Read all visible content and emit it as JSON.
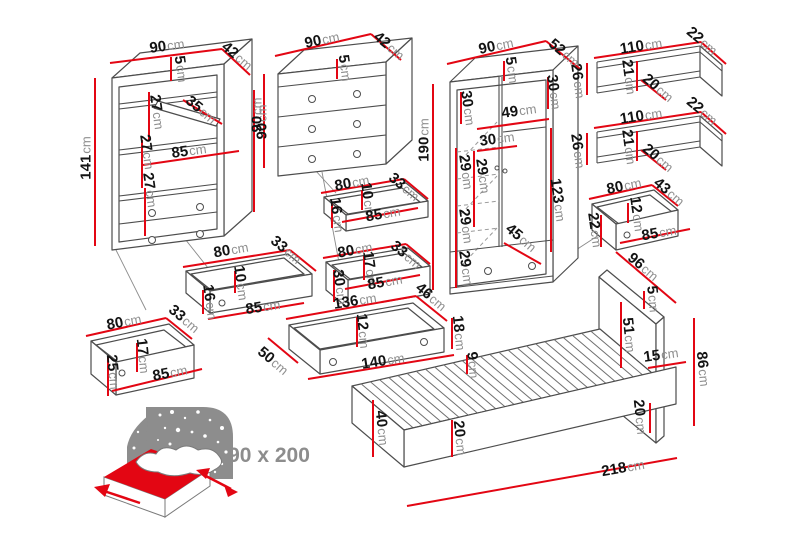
{
  "units_suffix": "cm",
  "mattress_size_label": "90 x 200",
  "colors": {
    "dimension_red": "#e30613",
    "outline_gray": "#4d4d4d",
    "unit_gray": "#8f8f8f",
    "icon_gray": "#8d8d8d"
  },
  "pieces": {
    "bookcase": {
      "width": "90",
      "depth": "42",
      "height": "141",
      "top": "5",
      "gap_top": "27",
      "shelf": "35",
      "gap_mid": "27",
      "inner_width": "85",
      "gap_low": "27",
      "side_height": "90"
    },
    "dresser": {
      "width": "90",
      "depth": "42",
      "height": "90",
      "top": "5"
    },
    "dresser_drawer_small": {
      "width": "80",
      "depth": "33",
      "inner_height": "10",
      "front_height": "16",
      "inner_width": "85"
    },
    "dresser_drawer_big": {
      "width": "80",
      "depth": "33",
      "inner_height": "17",
      "front_height": "30",
      "inner_width": "85"
    },
    "wardrobe": {
      "width": "90",
      "depth": "52",
      "height": "190",
      "top": "5",
      "top_right": "30",
      "rod_width": "49",
      "left_top": "30",
      "left_width": "30",
      "inner_gap": "29",
      "gap1": "29",
      "gap2": "29",
      "gap3": "29",
      "diagonal": "45",
      "hanging_height": "123"
    },
    "wall_shelf_top": {
      "width": "110",
      "depth": "22",
      "inner_height": "21",
      "inner_depth": "20",
      "height": "26"
    },
    "wall_shelf_bottom": {
      "width": "110",
      "depth": "22",
      "inner_height": "21",
      "inner_depth": "20",
      "height": "26"
    },
    "wardrobe_drawer": {
      "width": "80",
      "depth": "43",
      "inner_height": "12",
      "inner_width": "85",
      "front_height": "22"
    },
    "bookcase_drawer": {
      "width": "80",
      "depth": "33",
      "inner_height": "10",
      "front_height": "16",
      "inner_width": "85"
    },
    "bookcase_drawer_deep": {
      "width": "80",
      "depth": "33",
      "inner_height": "17",
      "front_height": "25",
      "inner_width": "85"
    },
    "bed_drawer": {
      "width": "136",
      "depth": "46",
      "inner_height": "12",
      "front_height": "18",
      "front_length": "140",
      "side_depth": "50"
    },
    "bed": {
      "rail": "9",
      "foot_height": "40",
      "frame_height": "20",
      "length": "218",
      "headboard_diag": "96",
      "headboard_top": "5",
      "headboard_upper": "51",
      "ledge": "15",
      "headboard_height": "86",
      "base_height": "20"
    }
  }
}
